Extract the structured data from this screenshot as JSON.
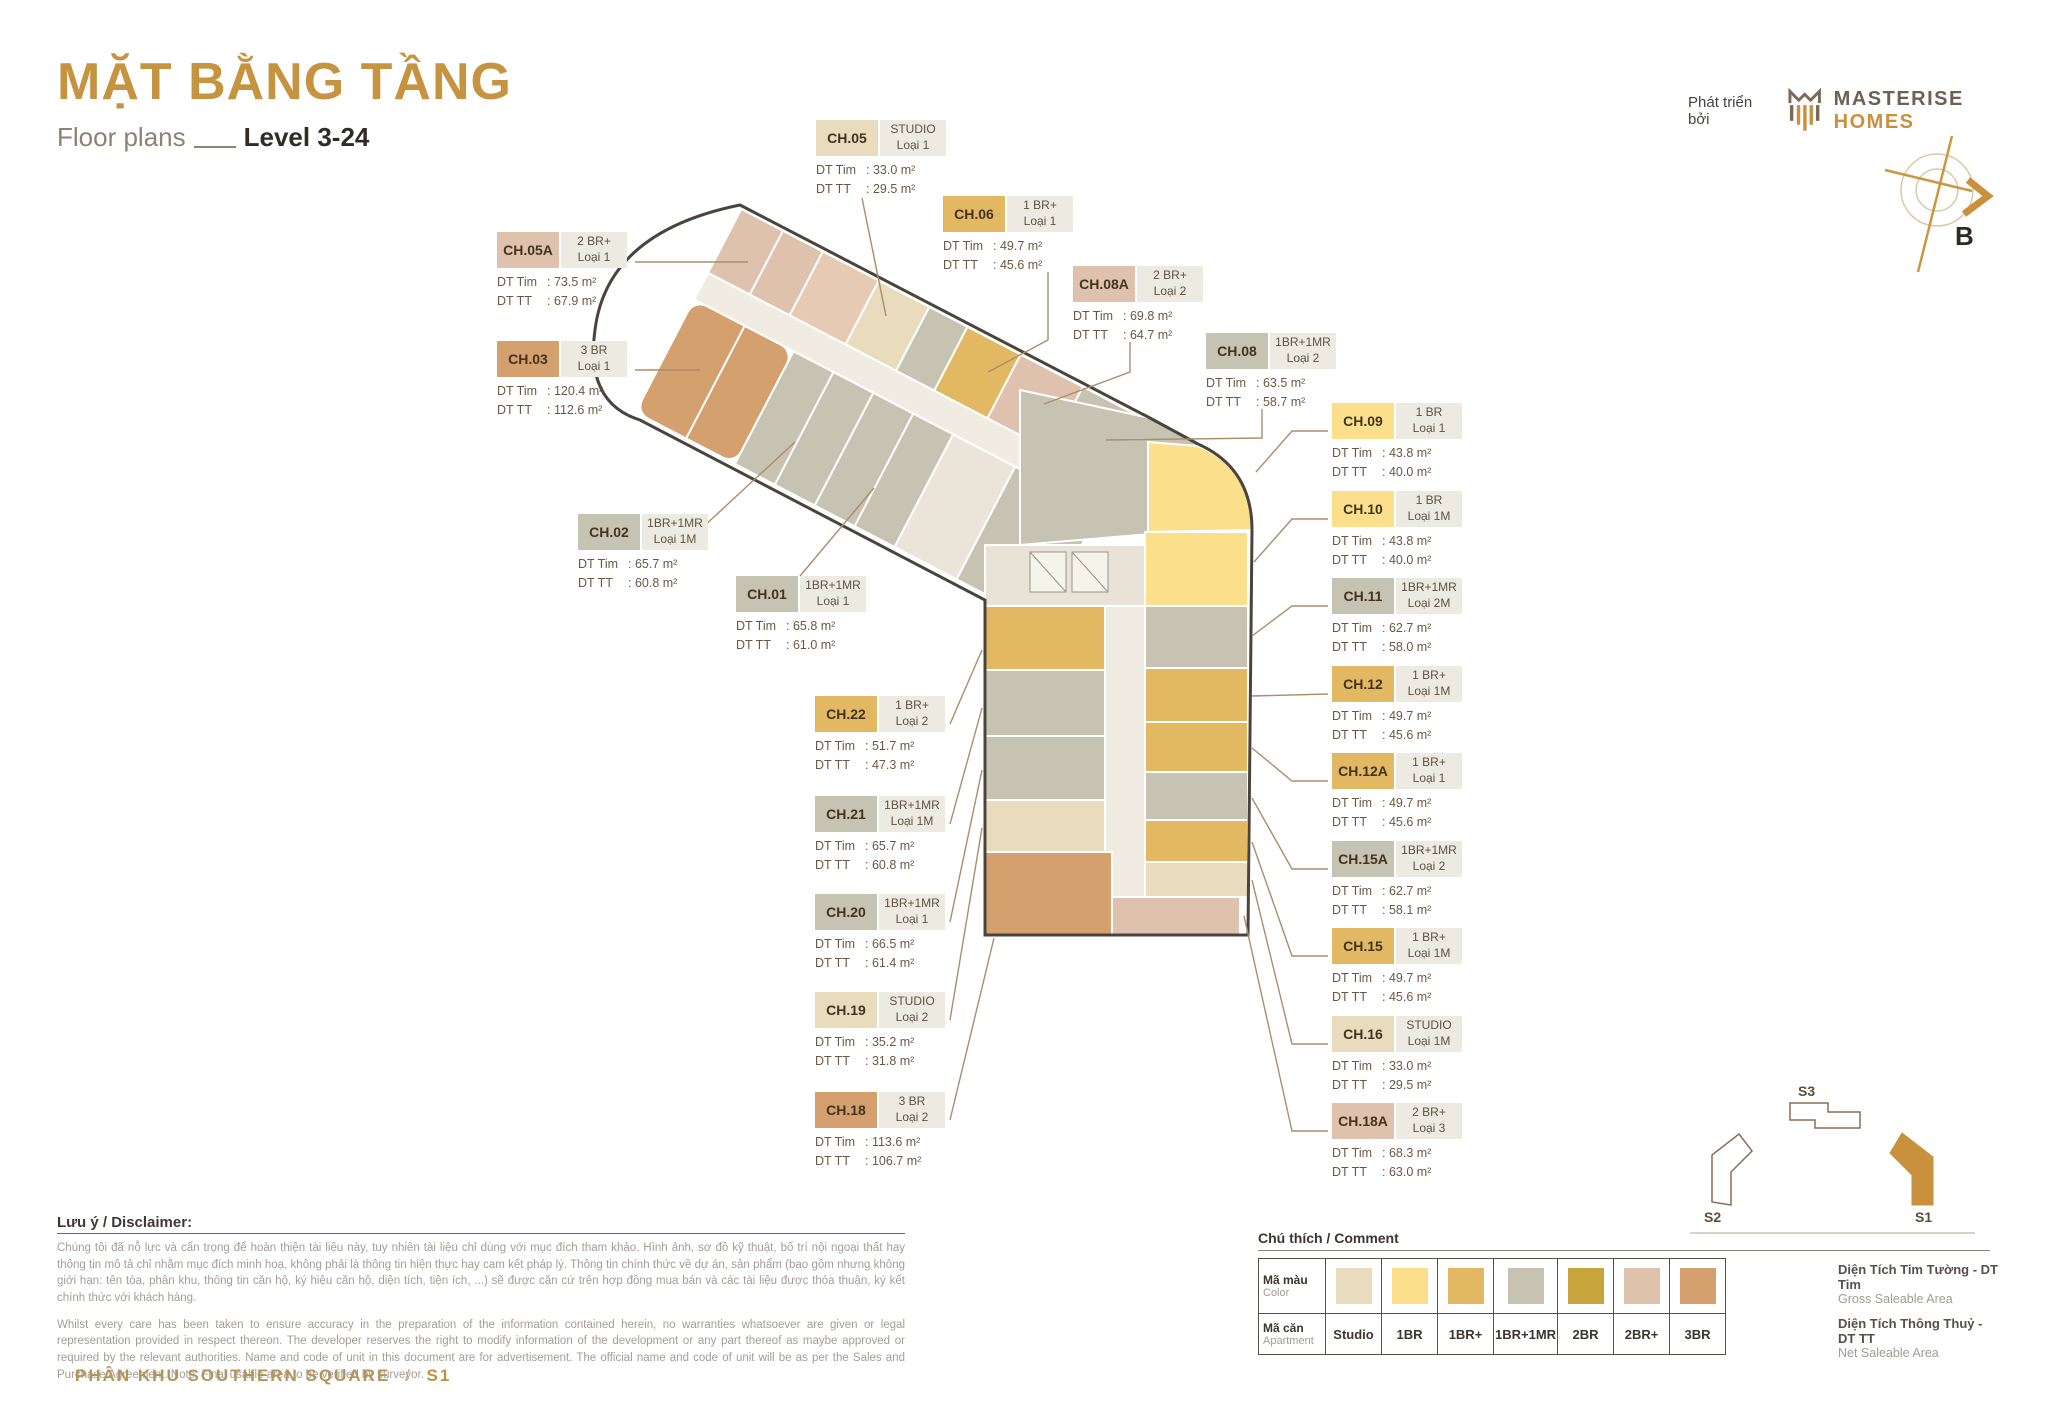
{
  "header": {
    "title": "MẶT BẰNG TẦNG",
    "subtitle": "Floor plans",
    "level": "Level 3-24",
    "developer_prefix": "Phát triển bởi",
    "brand": {
      "name1": "MASTERISE",
      "name2": "HOMES"
    },
    "compass_label": "B"
  },
  "strings": {
    "dt_tim": "DT Tim",
    "dt_tt": "DT TT"
  },
  "units": [
    {
      "code": "CH.05A",
      "type": "2 BR+",
      "variant": "Loại 1",
      "tim": ": 73.5 m²",
      "tt": ": 67.9 m²",
      "color_key": "2BR+"
    },
    {
      "code": "CH.03",
      "type": "3 BR",
      "variant": "Loại 1",
      "tim": ": 120.4 m²",
      "tt": ": 112.6 m²",
      "color_key": "3BR"
    },
    {
      "code": "CH.02",
      "type": "1BR+1MR",
      "variant": "Loại 1M",
      "tim": ": 65.7 m²",
      "tt": ": 60.8 m²",
      "color_key": "1BR+1MR"
    },
    {
      "code": "CH.01",
      "type": "1BR+1MR",
      "variant": "Loại 1",
      "tim": ": 65.8 m²",
      "tt": ": 61.0 m²",
      "color_key": "1BR+1MR"
    },
    {
      "code": "CH.22",
      "type": "1 BR+",
      "variant": "Loại 2",
      "tim": ": 51.7 m²",
      "tt": ": 47.3 m²",
      "color_key": "1BR+"
    },
    {
      "code": "CH.21",
      "type": "1BR+1MR",
      "variant": "Loại 1M",
      "tim": ": 65.7 m²",
      "tt": ": 60.8 m²",
      "color_key": "1BR+1MR"
    },
    {
      "code": "CH.20",
      "type": "1BR+1MR",
      "variant": "Loại 1",
      "tim": ": 66.5 m²",
      "tt": ": 61.4 m²",
      "color_key": "1BR+1MR"
    },
    {
      "code": "CH.19",
      "type": "STUDIO",
      "variant": "Loại 2",
      "tim": ": 35.2 m²",
      "tt": ": 31.8 m²",
      "color_key": "Studio"
    },
    {
      "code": "CH.18",
      "type": "3 BR",
      "variant": "Loại 2",
      "tim": ": 113.6 m²",
      "tt": ": 106.7 m²",
      "color_key": "3BR"
    },
    {
      "code": "CH.05",
      "type": "STUDIO",
      "variant": "Loại 1",
      "tim": ": 33.0 m²",
      "tt": ": 29.5 m²",
      "color_key": "Studio"
    },
    {
      "code": "CH.06",
      "type": "1 BR+",
      "variant": "Loại 1",
      "tim": ": 49.7 m²",
      "tt": ": 45.6 m²",
      "color_key": "1BR+"
    },
    {
      "code": "CH.08A",
      "type": "2 BR+",
      "variant": "Loại 2",
      "tim": ": 69.8 m²",
      "tt": ": 64.7 m²",
      "color_key": "2BR+"
    },
    {
      "code": "CH.08",
      "type": "1BR+1MR",
      "variant": "Loại 2",
      "tim": ": 63.5 m²",
      "tt": ": 58.7 m²",
      "color_key": "1BR+1MR"
    },
    {
      "code": "CH.09",
      "type": "1 BR",
      "variant": "Loại 1",
      "tim": ": 43.8 m²",
      "tt": ": 40.0 m²",
      "color_key": "1BR"
    },
    {
      "code": "CH.10",
      "type": "1 BR",
      "variant": "Loại 1M",
      "tim": ": 43.8 m²",
      "tt": ": 40.0 m²",
      "color_key": "1BR"
    },
    {
      "code": "CH.11",
      "type": "1BR+1MR",
      "variant": "Loại 2M",
      "tim": ": 62.7 m²",
      "tt": ": 58.0 m²",
      "color_key": "1BR+1MR"
    },
    {
      "code": "CH.12",
      "type": "1 BR+",
      "variant": "Loại 1M",
      "tim": ": 49.7 m²",
      "tt": ": 45.6 m²",
      "color_key": "1BR+"
    },
    {
      "code": "CH.12A",
      "type": "1 BR+",
      "variant": "Loại 1",
      "tim": ": 49.7 m²",
      "tt": ": 45.6 m²",
      "color_key": "1BR+"
    },
    {
      "code": "CH.15A",
      "type": "1BR+1MR",
      "variant": "Loại 2",
      "tim": ": 62.7 m²",
      "tt": ": 58.1 m²",
      "color_key": "1BR+1MR"
    },
    {
      "code": "CH.15",
      "type": "1 BR+",
      "variant": "Loại 1M",
      "tim": ": 49.7 m²",
      "tt": ": 45.6 m²",
      "color_key": "1BR+"
    },
    {
      "code": "CH.16",
      "type": "STUDIO",
      "variant": "Loại 1M",
      "tim": ": 33.0 m²",
      "tt": ": 29.5 m²",
      "color_key": "Studio"
    },
    {
      "code": "CH.18A",
      "type": "2 BR+",
      "variant": "Loại 3",
      "tim": ": 68.3 m²",
      "tt": ": 63.0 m²",
      "color_key": "2BR+"
    }
  ],
  "legend": {
    "title": "Chú thích / Comment",
    "row1": {
      "vi": "Mã màu",
      "en": "Color"
    },
    "row2": {
      "vi": "Mã căn",
      "en": "Apartment"
    },
    "types": [
      {
        "label": "Studio",
        "color": "#e9dcbd"
      },
      {
        "label": "1BR",
        "color": "#fbdf8b"
      },
      {
        "label": "1BR+",
        "color": "#e2b862"
      },
      {
        "label": "1BR+1MR",
        "color": "#c7c3b3"
      },
      {
        "label": "2BR",
        "color": "#c8a43c"
      },
      {
        "label": "2BR+",
        "color": "#dfc2ae"
      },
      {
        "label": "3BR",
        "color": "#d3a06e"
      }
    ]
  },
  "area_notes": [
    {
      "vi": "Diện Tích Tim Tường - DT Tim",
      "en": "Gross Saleable Area"
    },
    {
      "vi": "Diện Tích Thông Thuỷ - DT TT",
      "en": "Net Saleable Area"
    }
  ],
  "disclaimer": {
    "heading": "Lưu ý / Disclaimer:",
    "vi": "Chúng tôi đã nỗ lực và cẩn trọng để hoàn thiện tài liệu này, tuy nhiên tài liệu chỉ dùng với mục đích tham khảo. Hình ảnh, sơ đồ kỹ thuật, bố trí nội ngoại thất hay thông tin mô tả chỉ nhằm mục đích minh hoạ, không phải là thông tin hiện thực hay cam kết pháp lý. Thông tin chính thức về dự án, sản phẩm (bao gồm nhưng không giới hạn: tên tòa, phân khu, thông tin căn hộ, ký hiệu căn hộ, diện tích, tiện ích, ...) sẽ được căn cứ trên hợp đồng mua bán và các tài liệu được thỏa thuận, ký kết chính thức với khách hàng.",
    "en": "Whilst every care has been taken to ensure accuracy in the preparation of the information contained herein, no warranties whatsoever are given or legal representation provided in respect thereon. The developer reserves the right to modify information of the development or any part thereof as maybe approved or required by the relevant authorities. Name and code of unit in this document are for advertisement. The official name and code of unit will be as per the Sales and Purchase Agreement. Note: Final usable area to be verified by surveyor."
  },
  "minimap": {
    "blocks": [
      {
        "label": "S3"
      },
      {
        "label": "S2"
      },
      {
        "label": "S1"
      }
    ]
  },
  "footer": {
    "zone": "PHÂN KHU SOUTHERN SQUARE",
    "sep": "/",
    "block": "S1"
  }
}
